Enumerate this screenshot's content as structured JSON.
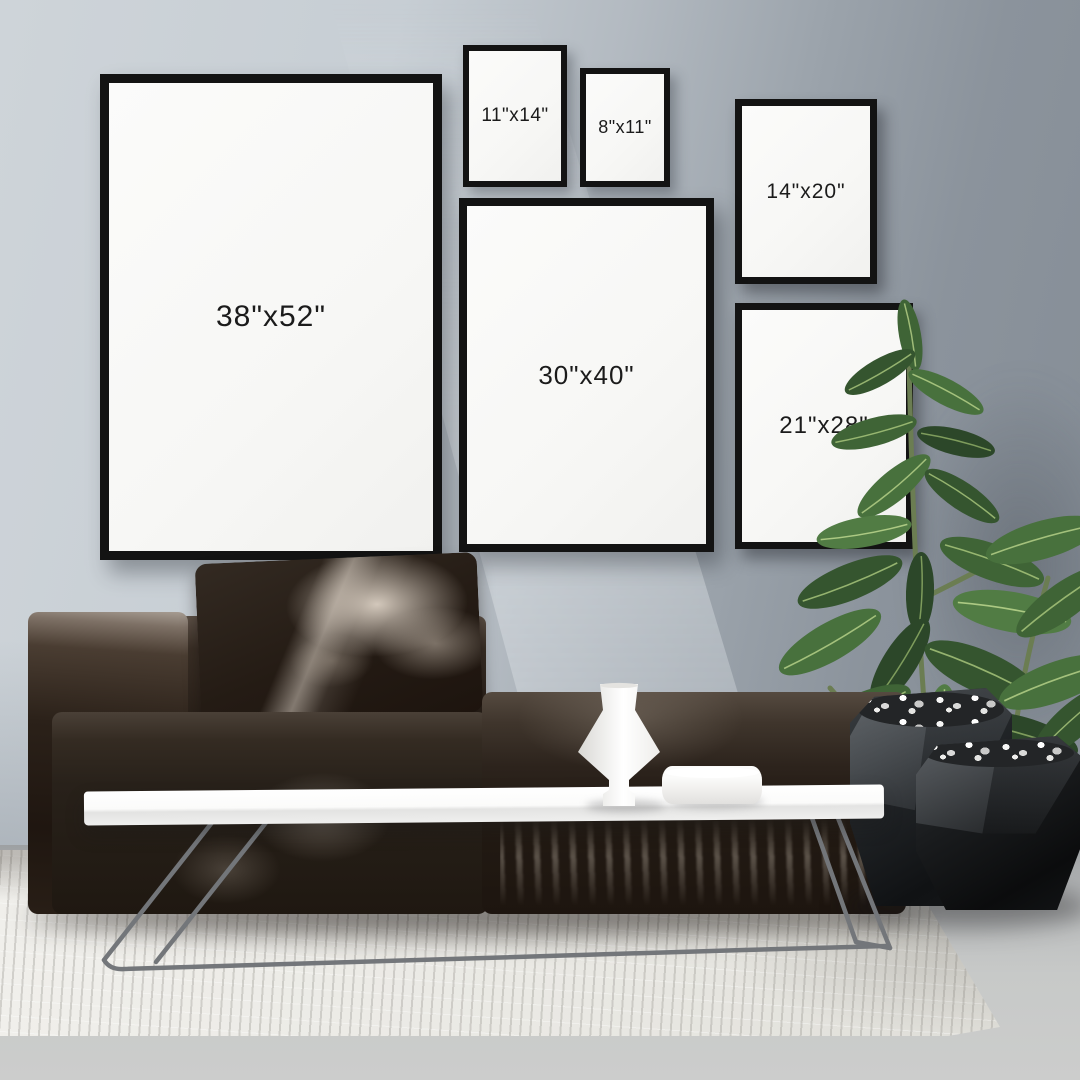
{
  "scene": {
    "description": "Living room wall-art size mockup with six black frames, dark sofa, white coffee table, ficus plant in black geometric planters and a white textured rug"
  },
  "frames": [
    {
      "id": "38x52",
      "label": "38\"x52\""
    },
    {
      "id": "11x14",
      "label": "11\"x14\""
    },
    {
      "id": "8x11",
      "label": "8\"x11\""
    },
    {
      "id": "14x20",
      "label": "14\"x20\""
    },
    {
      "id": "30x40",
      "label": "30\"x40\""
    },
    {
      "id": "21x28",
      "label": "21\"x28\""
    }
  ],
  "palette": {
    "wall_light": "#c7ced4",
    "wall_dark": "#858d96",
    "frame_border": "#131313",
    "frame_mat": "#f8f8f6",
    "label_text": "#1b1b1b",
    "sofa_dark": "#241c15",
    "table_white": "#f6f6f5",
    "plant_green": "#46663c",
    "planter_black": "#141618",
    "rug_white": "#ebeae5",
    "floor_gray": "#c2c4c4"
  }
}
